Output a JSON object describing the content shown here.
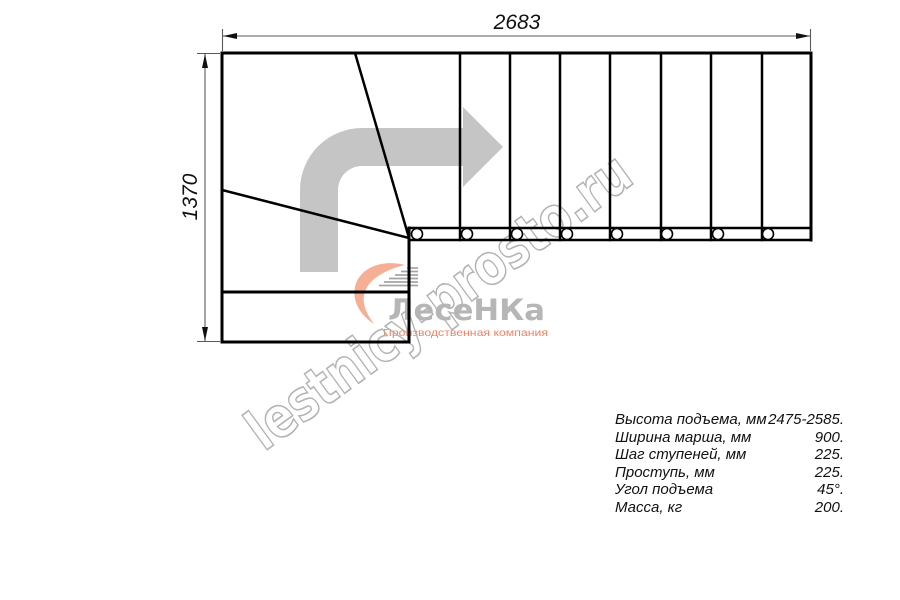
{
  "page": {
    "background": "#ffffff"
  },
  "drawing": {
    "dim_width_label": "2683",
    "dim_height_label": "1370",
    "line_color": "#000000",
    "dimension_color": "#595959",
    "arrow_color": "#c5c5c5"
  },
  "watermark": {
    "diagonal_text": "lestnicy-prosto.ru",
    "outline_color": "#b3b3b3",
    "logo": {
      "title": "ЛесеНКа",
      "subtitle": "Производственная компания",
      "title_color": "#b6b6b6",
      "subtitle_color": "#ec8464",
      "swoosh_color": "#f4a182",
      "steps_color": "#9b9b9b"
    }
  },
  "specs": {
    "rows": [
      {
        "label": "Высота подъема, мм",
        "value": "2475-2585."
      },
      {
        "label": "Ширина марша, мм",
        "value": "900."
      },
      {
        "label": "Шаг ступеней, мм",
        "value": "225."
      },
      {
        "label": "Проступь, мм",
        "value": "225."
      },
      {
        "label": "Угол подъема",
        "value": "45°."
      },
      {
        "label": "Масса, кг",
        "value": "200."
      }
    ]
  }
}
